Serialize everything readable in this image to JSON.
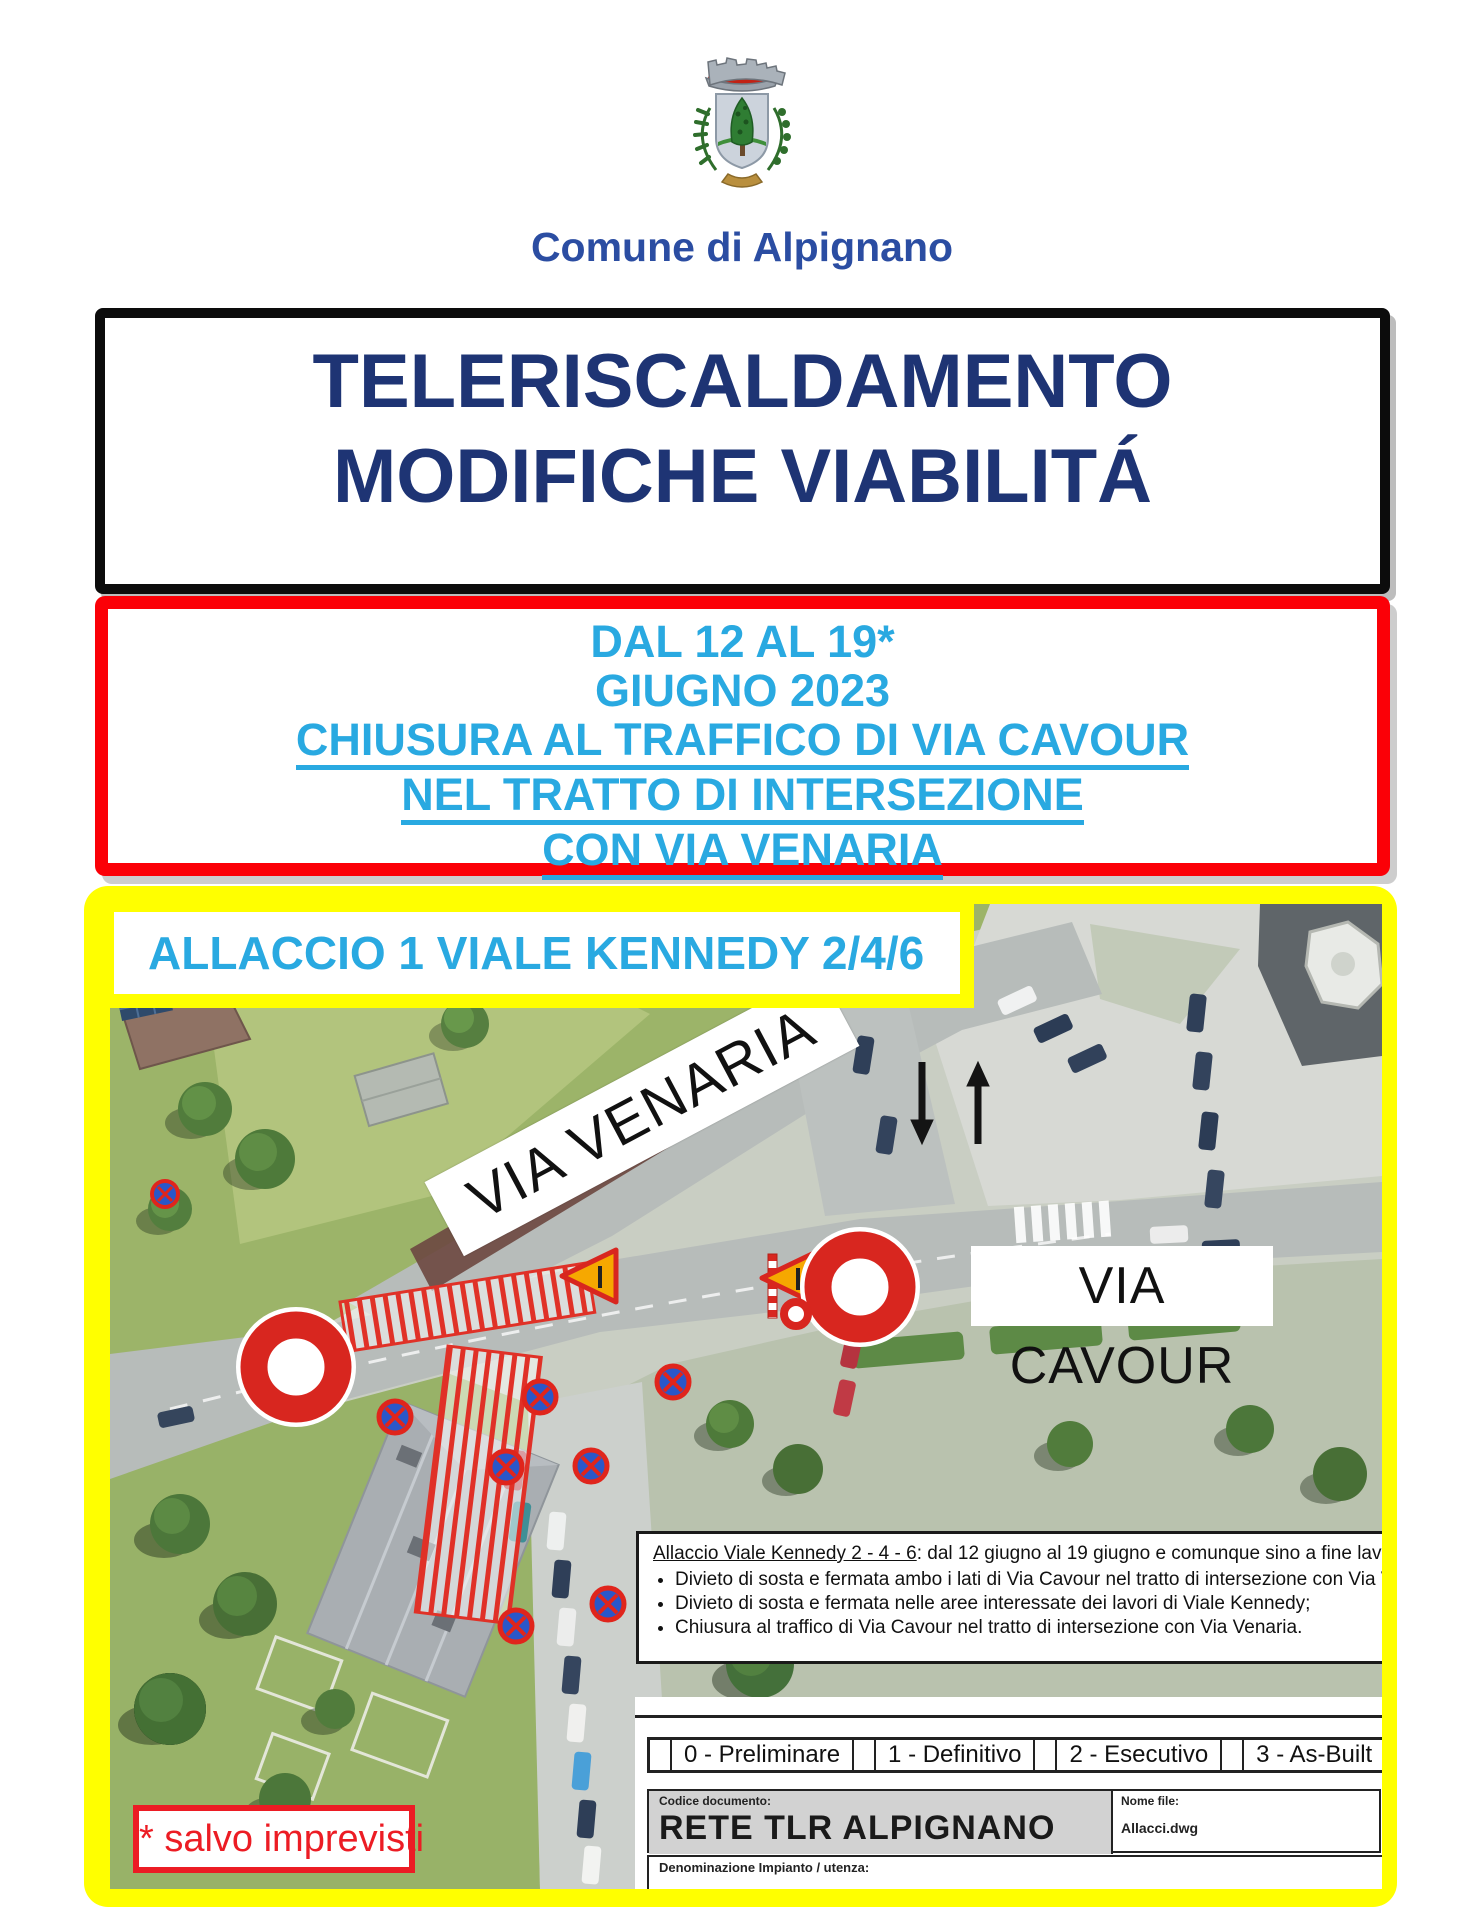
{
  "header": {
    "municipality": "Comune di Alpignano",
    "crest_icon": "alpignano-coat-of-arms"
  },
  "title_box": {
    "line1": "TELERISCALDAMENTO",
    "line2": "MODIFICHE VIABILITÁ"
  },
  "notice_box": {
    "line1": "DAL 12 AL 19*",
    "line2": "GIUGNO 2023",
    "line3": "CHIUSURA AL TRAFFICO DI VIA CAVOUR",
    "line4": "NEL TRATTO DI INTERSEZIONE",
    "line5": "CON VIA VENARIA"
  },
  "map": {
    "section_label": "ALLACCIO 1 VIALE KENNEDY 2/4/6",
    "street_labels": {
      "venaria": "VIA VENARIA",
      "cavour": "VIA CAVOUR"
    },
    "legend": {
      "heading_underlined": "Allaccio Viale Kennedy 2 - 4 - 6",
      "heading_rest": ": dal 12 giugno al 19 giugno e comunque sino a fine lavori:",
      "bullets": [
        "Divieto di sosta e fermata ambo i lati di Via Cavour nel tratto di intersezione con Via Venaria;",
        "Divieto di sosta e fermata nelle aree interessate dei lavori di Viale Kennedy;",
        "Chiusura al traffico di Via Cavour nel tratto di intersezione con Via Venaria."
      ]
    },
    "titleblock": {
      "revisions": [
        "0 - Preliminare",
        "1 - Definitivo",
        "2 - Esecutivo",
        "3 - As-Built"
      ],
      "codice_label": "Codice documento:",
      "codice_value": "RETE TLR ALPIGNANO",
      "file_label": "Nome file:",
      "file_value": "Allacci.dwg",
      "denominazione_label": "Denominazione Impianto / utenza:"
    },
    "footnote": "* salvo imprevisti"
  },
  "colors": {
    "accent_light_blue": "#29a9e1",
    "title_navy": "#1e3474",
    "municipality_blue": "#2b4da2",
    "notice_border_red": "#fb0007",
    "map_frame_yellow": "#ffff00",
    "road_sign_red": "#d8261f",
    "footnote_red": "#ec1c24"
  }
}
